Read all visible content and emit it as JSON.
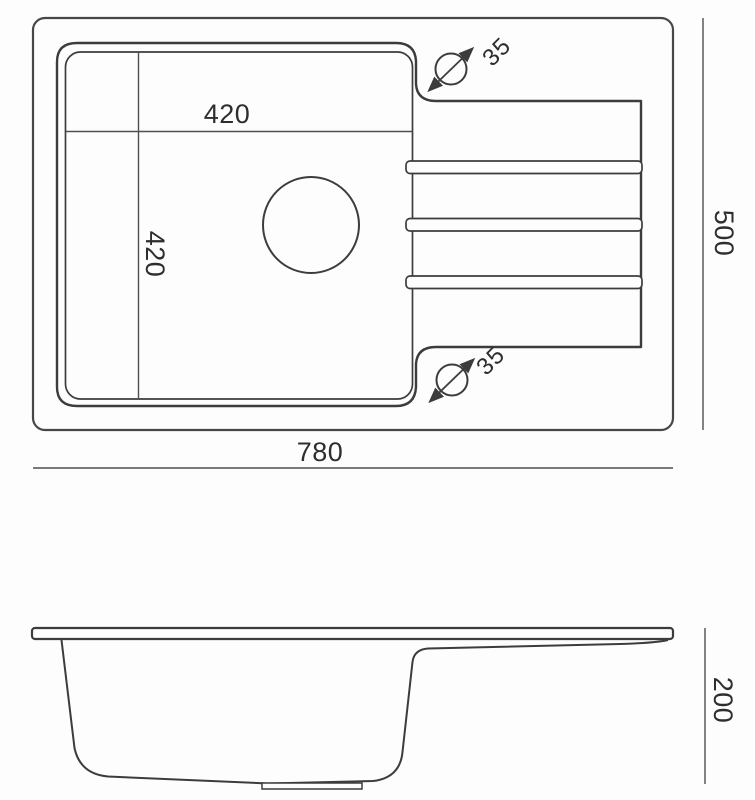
{
  "drawing": {
    "subject": "kitchen-sink-technical-drawing",
    "views": {
      "top_view": {
        "overall_width": "780",
        "overall_depth": "500",
        "bowl_width": "420",
        "bowl_depth": "420",
        "tap_hole_top_diameter": "35",
        "tap_hole_bottom_diameter": "35",
        "ridge_count": 3
      },
      "side_view": {
        "bowl_height": "200"
      }
    },
    "colors": {
      "outline": "#3c3c3c",
      "dimension_line": "#4f4f4f",
      "text": "#2e2e2e",
      "background": "#fdfdfd"
    }
  }
}
